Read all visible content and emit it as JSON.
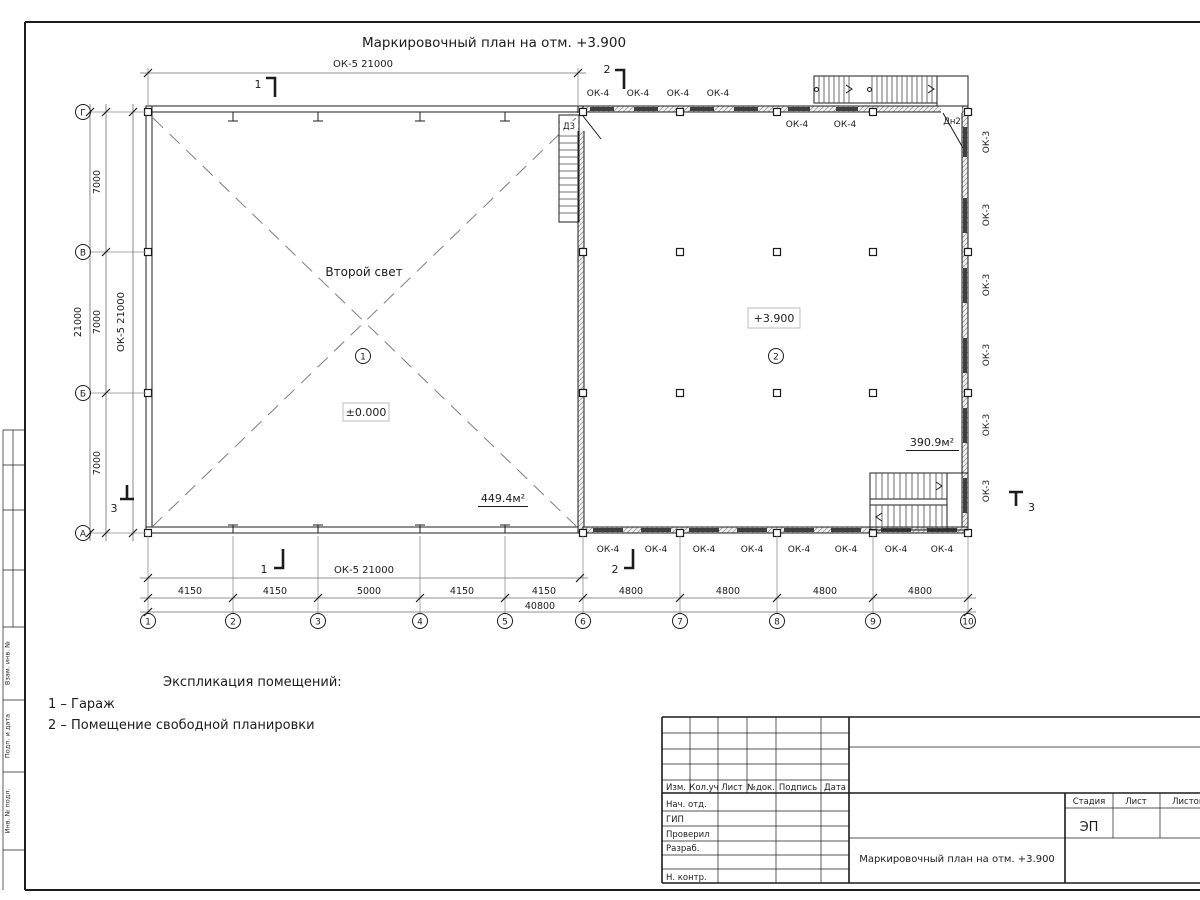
{
  "sheet": {
    "title": "Маркировочный план на отм. +3.900"
  },
  "plan": {
    "rooms": [
      {
        "number": "1",
        "name": "Гараж",
        "note": "Второй свет",
        "level": "±0.000",
        "area": "449.4м²"
      },
      {
        "number": "2",
        "name": "Помещение свободной планировки",
        "level": "+3.900",
        "area": "390.9м²"
      }
    ],
    "door_labels": {
      "d3": "Д3",
      "dn2": "Дн2"
    },
    "window_labels": {
      "ok3": "ОК-3",
      "ok4": "ОК-4",
      "ok5": "ОК-5 21000"
    }
  },
  "grid": {
    "cols": [
      "1",
      "2",
      "3",
      "4",
      "5",
      "6",
      "7",
      "8",
      "9",
      "10"
    ],
    "rows": [
      "Г",
      "В",
      "Б",
      "А"
    ]
  },
  "dims": {
    "col_spans": [
      "4150",
      "4150",
      "5000",
      "4150",
      "4150",
      "4800",
      "4800",
      "4800",
      "4800"
    ],
    "col_total": "40800",
    "row_spans": [
      "7000",
      "7000",
      "7000"
    ],
    "row_total": "21000"
  },
  "sections": {
    "s1": "1",
    "s2": "2",
    "s3": "3"
  },
  "legend": {
    "heading": "Экспликация помещений:",
    "items": [
      "1 – Гараж",
      "2 – Помещение свободной планировки"
    ]
  },
  "title_block": {
    "change_cols": [
      "Изм.",
      "Кол.уч",
      "Лист",
      "№док.",
      "Подпись",
      "Дата"
    ],
    "sign_rows": [
      "Нач. отд.",
      "ГИП",
      "Проверил",
      "Разраб.",
      "Н. контр."
    ],
    "stage_label": "Стадия",
    "sheet_label": "Лист",
    "sheets_label": "Листов",
    "stage_value": "ЭП",
    "doc_title": "Маркировочный план на отм. +3.900"
  },
  "side_stamp": {
    "cells": [
      "Взам. инв. №",
      "Подп. и дата",
      "Инв. № подл."
    ]
  }
}
